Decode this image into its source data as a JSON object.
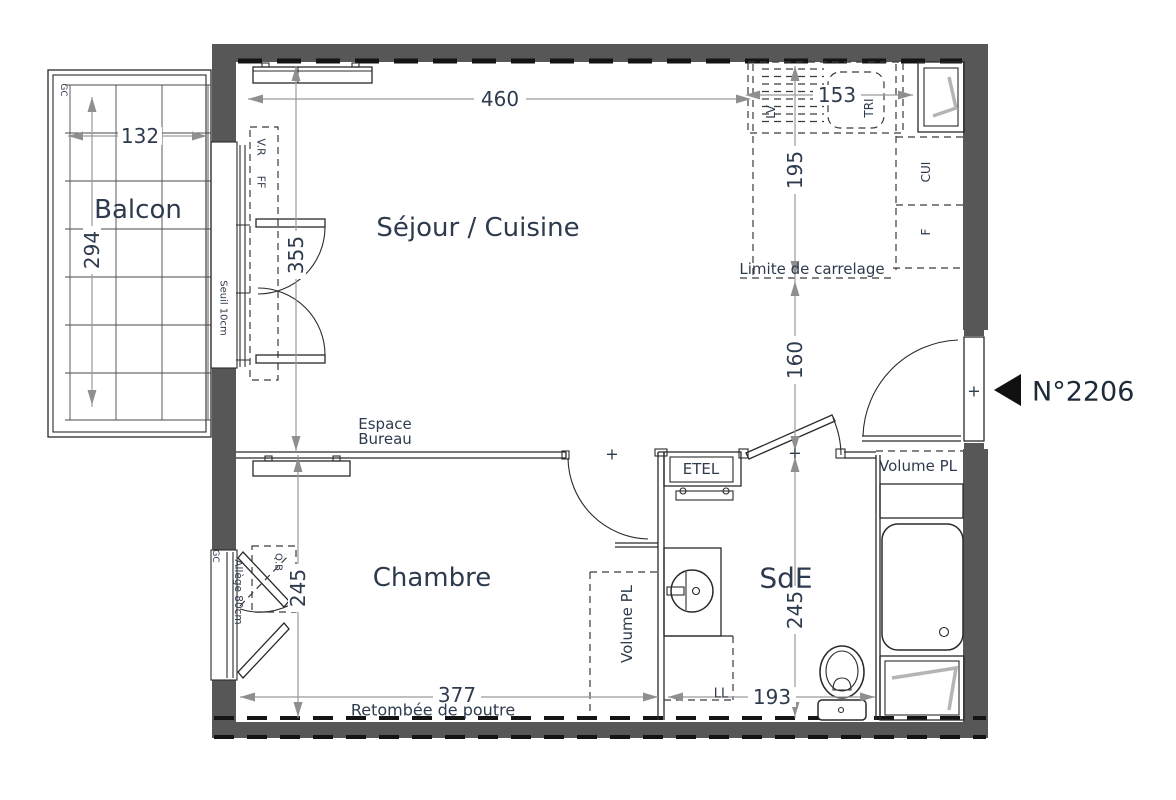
{
  "unit": {
    "number": "N°2206"
  },
  "rooms": {
    "sejour": "Séjour / Cuisine",
    "chambre": "Chambre",
    "sde": "SdE",
    "balcon": "Balcon"
  },
  "dims": {
    "sejour_width": "460",
    "kitchen_width": "153",
    "kitchen_depth": "195",
    "entry_depth": "160",
    "sejour_depth": "355",
    "chambre_depth": "245",
    "sde_depth": "245",
    "chambre_width": "377",
    "sde_width": "193",
    "balcon_width": "132",
    "balcon_depth": "294"
  },
  "labels": {
    "espace_bureau_1": "Espace",
    "espace_bureau_2": "Bureau",
    "etel": "ETEL",
    "volume_pl_sde": "Volume PL",
    "volume_pl_chambre": "Volume PL",
    "ll": "LL",
    "lv": "LV",
    "tri": "TRI",
    "cui": "CUI",
    "f": "F",
    "vr": "V.R",
    "ff": "FF",
    "seuil": "Seuil 10cm",
    "allege": "Allège 80cm",
    "qb": "Q.B",
    "gc_balcony": "GC",
    "gc_chambre": "GC",
    "limite_carrelage": "Limite de carrelage",
    "retombee_poutre": "Retombée de poutre",
    "door_axis": "+"
  },
  "colors": {
    "wall": "#575757",
    "line": "#1c1c1c",
    "text": "#2e3b4e",
    "dim_line": "#9a9a9a",
    "glass_symbol": "#b5b5b5"
  }
}
